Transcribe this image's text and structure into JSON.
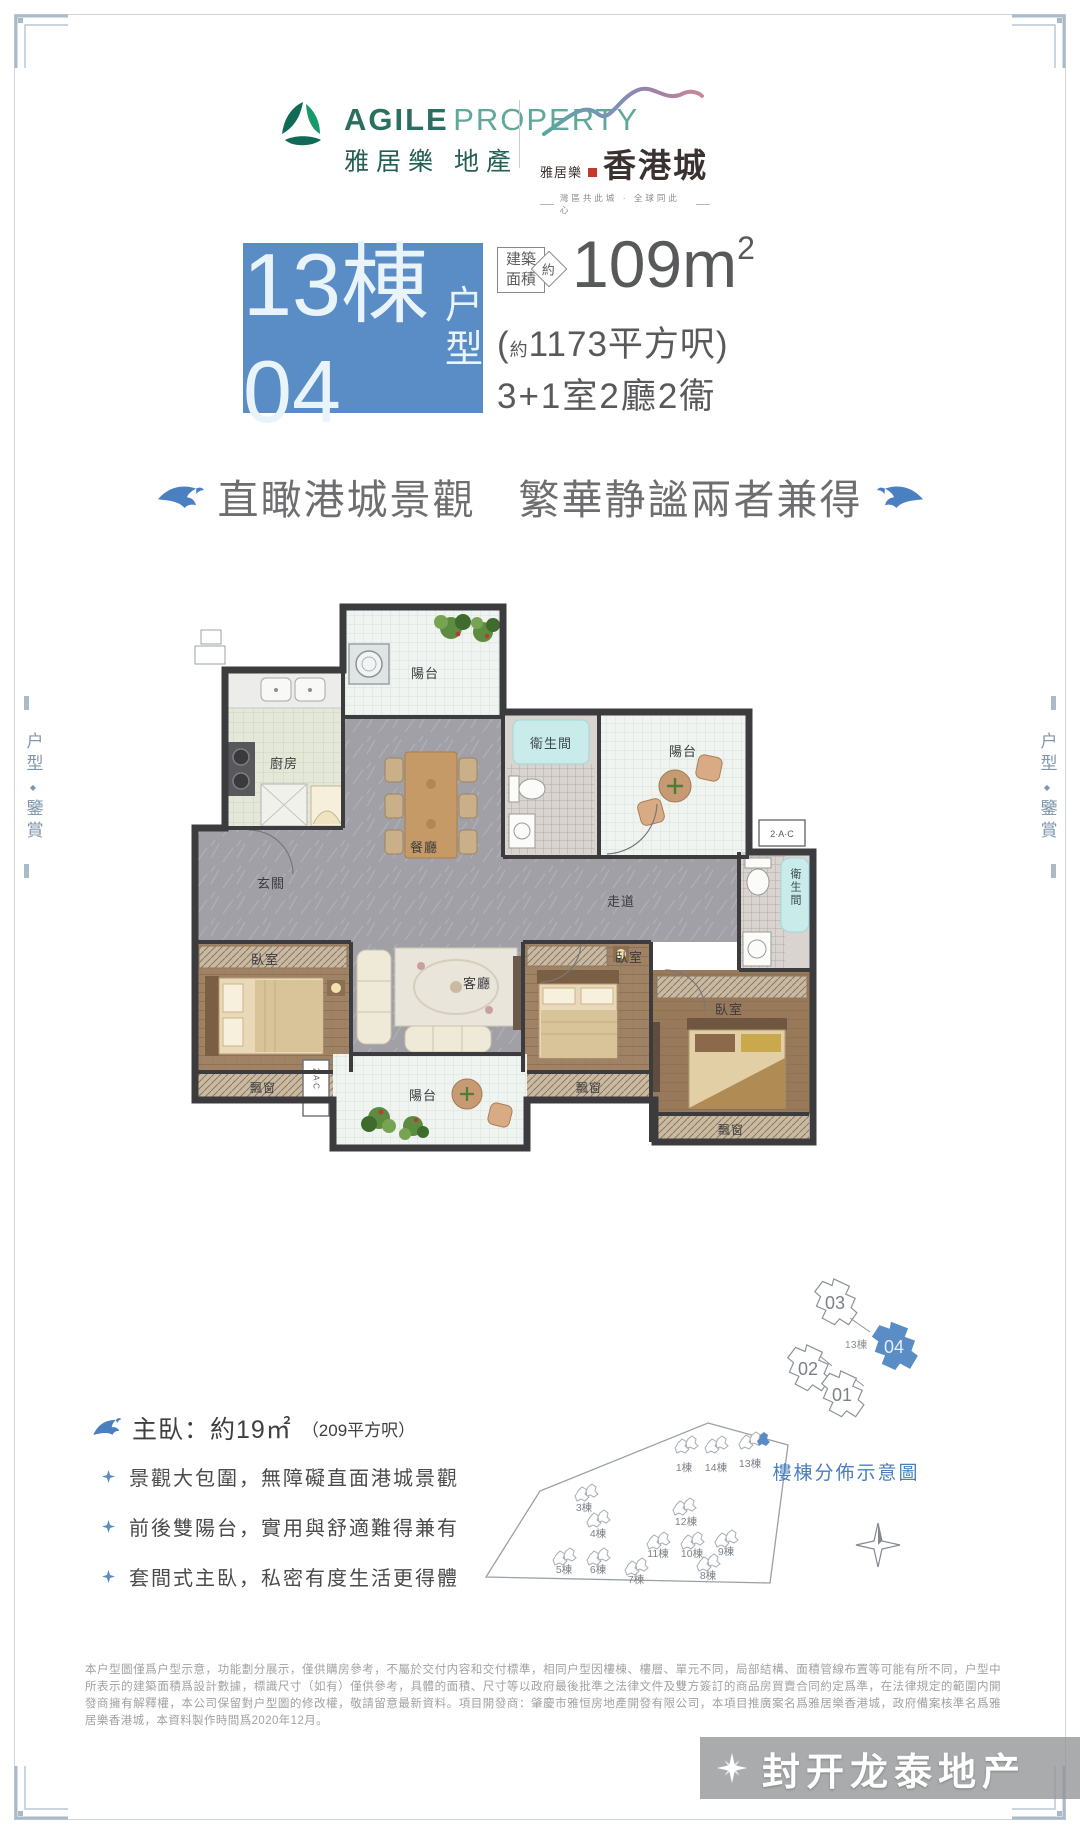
{
  "colors": {
    "accent_blue": "#5a8cc5",
    "brand_green": "#2b6f60",
    "text_dark": "#58595b",
    "dolphin_blue": "#4a7fc1"
  },
  "header": {
    "agile_en_bold": "AGILE",
    "agile_en_light": "PROPERTY",
    "agile_cn": "雅居樂 地產",
    "project_prefix": "雅居樂",
    "project_name": "香港城",
    "project_slogan": "灣區共此城 · 全球同此心"
  },
  "title": {
    "block_main": "13棟04",
    "block_suffix_1": "户",
    "block_suffix_2": "型",
    "area_tag_1": "建築",
    "area_tag_2": "面積",
    "area_approx": "約",
    "area_value": "109m",
    "area_sup": "2",
    "area_paren_open": "(",
    "area_paren_approx": "約",
    "area_paren_rest": "1173平方呎)",
    "layout": "3+1室2廳2衞"
  },
  "tagline": "直瞰港城景觀　繁華静謐兩者兼得",
  "side_label": {
    "part1": "户型",
    "part2": "鑒賞",
    "separator": "◆"
  },
  "floorplan": {
    "balcony": "陽台",
    "kitchen": "廚房",
    "dining": "餐廳",
    "bathroom": "衛生間",
    "foyer": "玄關",
    "corridor": "走道",
    "bedroom": "臥室",
    "living": "客廳",
    "bay_window": "飄窗",
    "ac": "2·A·C"
  },
  "unit_diagram": {
    "building": "13棟",
    "unit_01": "01",
    "unit_02": "02",
    "unit_03": "03",
    "unit_04": "04"
  },
  "master": {
    "label_big": "主臥：約19㎡",
    "label_small": "（209平方呎）"
  },
  "bullets": [
    "景觀大包圍，無障礙直面港城景觀",
    "前後雙陽台，實用與舒適難得兼有",
    "套間式主臥，私密有度生活更得體"
  ],
  "siteplan": {
    "title": "樓棟分佈示意圖",
    "buildings": [
      "1棟",
      "14棟",
      "13棟",
      "3棟",
      "4棟",
      "12棟",
      "11棟",
      "10棟",
      "9棟",
      "5棟",
      "6棟",
      "7棟",
      "8棟"
    ]
  },
  "disclaimer": "本户型圖僅爲户型示意，功能劃分展示，僅供購房參考，不屬於交付内容和交付標準，相同户型因樓棟、樓層、單元不同，局部結構、面積管線布置等可能有所不同，户型中所表示的建築面積爲設計數據，標識尺寸（如有）僅供參考，具體的面積、尺寸等以政府最後批準之法律文件及雙方簽訂的商品房買賣合同約定爲準，在法律規定的範圍内開發商擁有解釋權，本公司保留對户型圖的修改權，敬請留意最新資料。項目開發商：肇慶市雅恒房地產開發有限公司，本項目推廣案名爲雅居樂香港城，政府備案核準名爲雅居樂香港城，本資料製作時間爲2020年12月。",
  "watermark": "封开龙泰地产"
}
